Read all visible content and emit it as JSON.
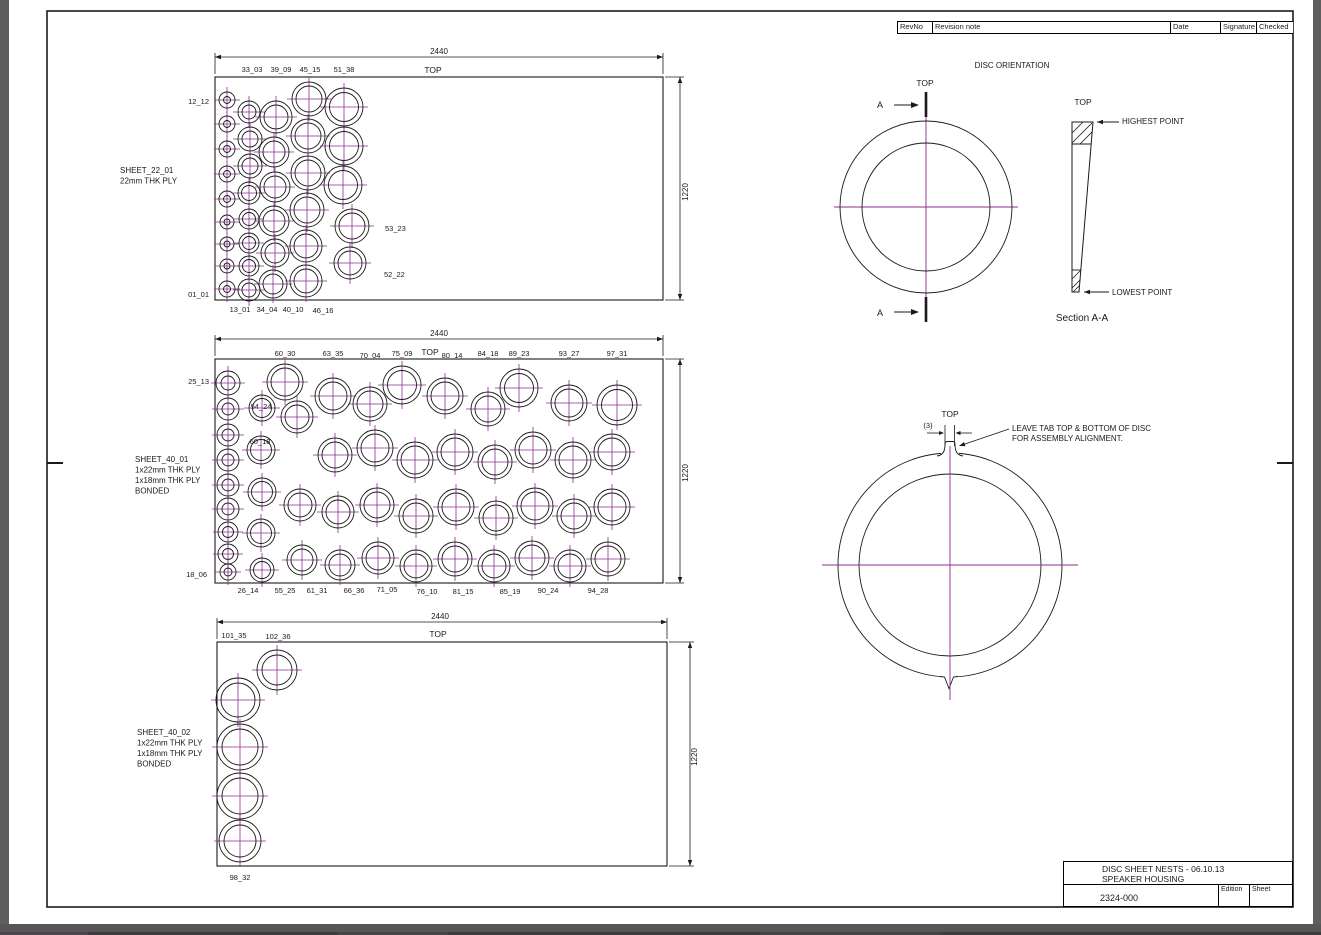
{
  "colors": {
    "paper": "#ffffff",
    "line": "#1a1a1a",
    "centerline": "#8e2d92",
    "chrome": "#5e5e5e"
  },
  "revision_table": {
    "columns": [
      "RevNo",
      "Revision note",
      "Date",
      "Signature",
      "Checked"
    ]
  },
  "title_block": {
    "line1": "DISC SHEET NESTS - 06.10.13",
    "line2": "SPEAKER HOUSING",
    "number": "2324-000",
    "edition_label": "Edition",
    "sheet_label": "Sheet"
  },
  "sheets": [
    {
      "name": "sheet-22-01",
      "note": [
        "SHEET_22_01",
        "22mm THK PLY"
      ],
      "note_pos": [
        120,
        173
      ],
      "rect": [
        215,
        77,
        448,
        223
      ],
      "dim_top": {
        "label": "2440",
        "y": 57,
        "text": [
          439,
          54
        ]
      },
      "dim_right": {
        "label": "1220",
        "x": 680,
        "text": [
          688,
          192
        ]
      },
      "top_label": {
        "t": "TOP",
        "x": 433,
        "y": 73
      },
      "labels": [
        {
          "t": "33_03",
          "x": 252,
          "y": 72
        },
        {
          "t": "39_09",
          "x": 281,
          "y": 72
        },
        {
          "t": "45_15",
          "x": 310,
          "y": 72
        },
        {
          "t": "51_38",
          "x": 344,
          "y": 72
        },
        {
          "t": "12_12",
          "x": 209,
          "y": 104,
          "a": "e"
        },
        {
          "t": "01_01",
          "x": 209,
          "y": 297,
          "a": "e"
        },
        {
          "t": "13_01",
          "x": 240,
          "y": 312
        },
        {
          "t": "34_04",
          "x": 267,
          "y": 312
        },
        {
          "t": "40_10",
          "x": 293,
          "y": 312
        },
        {
          "t": "46_16",
          "x": 323,
          "y": 313
        },
        {
          "t": "53_23",
          "x": 385,
          "y": 231,
          "a": "s"
        },
        {
          "t": "52_22",
          "x": 384,
          "y": 277,
          "a": "s"
        }
      ],
      "circles": [
        [
          227,
          100,
          8,
          3.5
        ],
        [
          227,
          124,
          8,
          3.5
        ],
        [
          227,
          149,
          8,
          3.5
        ],
        [
          227,
          174,
          8,
          3.5
        ],
        [
          227,
          199,
          8,
          3.5
        ],
        [
          227,
          222,
          7,
          3
        ],
        [
          227,
          244,
          7,
          3
        ],
        [
          227,
          266,
          7,
          3
        ],
        [
          227,
          289,
          8,
          3.5
        ],
        [
          249,
          112,
          11,
          7
        ],
        [
          250,
          139,
          12,
          8
        ],
        [
          250,
          166,
          12,
          8
        ],
        [
          249,
          193,
          11,
          7.5
        ],
        [
          249,
          219,
          10,
          6.5
        ],
        [
          249,
          243,
          10,
          6.5
        ],
        [
          249,
          266,
          10,
          6.5
        ],
        [
          249,
          290,
          11,
          7
        ],
        [
          276,
          117,
          16,
          12
        ],
        [
          274,
          152,
          15,
          11
        ],
        [
          275,
          187,
          15,
          11
        ],
        [
          274,
          221,
          15,
          11
        ],
        [
          275,
          253,
          14,
          10
        ],
        [
          273,
          284,
          14,
          10
        ],
        [
          309,
          99,
          17,
          13
        ],
        [
          308,
          136,
          17,
          13
        ],
        [
          308,
          173,
          17,
          13
        ],
        [
          307,
          210,
          17,
          13
        ],
        [
          306,
          246,
          16,
          12
        ],
        [
          306,
          281,
          16,
          12
        ],
        [
          344,
          107,
          19,
          14.5
        ],
        [
          344,
          146,
          19,
          14.5
        ],
        [
          343,
          185,
          19,
          14.5
        ],
        [
          352,
          226,
          17,
          13
        ],
        [
          350,
          263,
          16,
          12
        ]
      ]
    },
    {
      "name": "sheet-40-01",
      "note": [
        "SHEET_40_01",
        "1x22mm THK PLY",
        "1x18mm THK PLY",
        "BONDED"
      ],
      "note_pos": [
        135,
        462
      ],
      "rect": [
        215,
        359,
        448,
        224
      ],
      "dim_top": {
        "label": "2440",
        "y": 339,
        "text": [
          439,
          336
        ]
      },
      "dim_right": {
        "label": "1220",
        "x": 680,
        "text": [
          688,
          473
        ]
      },
      "top_label": {
        "t": "TOP",
        "x": 430,
        "y": 355
      },
      "labels": [
        {
          "t": "60_30",
          "x": 285,
          "y": 356
        },
        {
          "t": "63_35",
          "x": 333,
          "y": 356
        },
        {
          "t": "70_04",
          "x": 370,
          "y": 358
        },
        {
          "t": "75_09",
          "x": 402,
          "y": 356
        },
        {
          "t": "80_14",
          "x": 452,
          "y": 358
        },
        {
          "t": "84_18",
          "x": 488,
          "y": 356
        },
        {
          "t": "89_23",
          "x": 519,
          "y": 356
        },
        {
          "t": "93_27",
          "x": 569,
          "y": 356
        },
        {
          "t": "97_31",
          "x": 617,
          "y": 356
        },
        {
          "t": "25_13",
          "x": 209,
          "y": 384,
          "a": "e"
        },
        {
          "t": "18_06",
          "x": 207,
          "y": 577,
          "a": "e"
        },
        {
          "t": "54_24",
          "x": 261,
          "y": 409
        },
        {
          "t": "60_18",
          "x": 260,
          "y": 444
        },
        {
          "t": "26_14",
          "x": 248,
          "y": 593
        },
        {
          "t": "55_25",
          "x": 285,
          "y": 593
        },
        {
          "t": "61_31",
          "x": 317,
          "y": 593
        },
        {
          "t": "66_36",
          "x": 354,
          "y": 593
        },
        {
          "t": "71_05",
          "x": 387,
          "y": 592
        },
        {
          "t": "76_10",
          "x": 427,
          "y": 594
        },
        {
          "t": "81_15",
          "x": 463,
          "y": 594
        },
        {
          "t": "85_19",
          "x": 510,
          "y": 594
        },
        {
          "t": "90_24",
          "x": 548,
          "y": 593
        },
        {
          "t": "94_28",
          "x": 598,
          "y": 593
        }
      ],
      "circles": [
        [
          228,
          383,
          12,
          7
        ],
        [
          228,
          409,
          11,
          6
        ],
        [
          228,
          435,
          11,
          6
        ],
        [
          228,
          460,
          11,
          6
        ],
        [
          228,
          485,
          11,
          6
        ],
        [
          228,
          509,
          11,
          6
        ],
        [
          228,
          532,
          10,
          5.5
        ],
        [
          228,
          554,
          10,
          5.5
        ],
        [
          228,
          572,
          8,
          4
        ],
        [
          262,
          408,
          13,
          9.5
        ],
        [
          261,
          450,
          14,
          10.5
        ],
        [
          262,
          492,
          14,
          10.5
        ],
        [
          261,
          533,
          14,
          10.5
        ],
        [
          262,
          570,
          12,
          8.5
        ],
        [
          297,
          417,
          16,
          12
        ],
        [
          285,
          382,
          18,
          14
        ],
        [
          333,
          396,
          18,
          14
        ],
        [
          370,
          404,
          17,
          13
        ],
        [
          402,
          385,
          19,
          14.5
        ],
        [
          445,
          396,
          18,
          14
        ],
        [
          488,
          409,
          17,
          13
        ],
        [
          519,
          388,
          19,
          14.5
        ],
        [
          569,
          403,
          18,
          14
        ],
        [
          617,
          405,
          20,
          15.5
        ],
        [
          335,
          455,
          17,
          13
        ],
        [
          375,
          448,
          18,
          14
        ],
        [
          415,
          460,
          18,
          14
        ],
        [
          455,
          452,
          18,
          14
        ],
        [
          495,
          462,
          17,
          13
        ],
        [
          533,
          450,
          18,
          14
        ],
        [
          573,
          460,
          18,
          14
        ],
        [
          612,
          452,
          18,
          14
        ],
        [
          300,
          505,
          16,
          12
        ],
        [
          338,
          512,
          16,
          12
        ],
        [
          377,
          505,
          17,
          13
        ],
        [
          416,
          516,
          17,
          13
        ],
        [
          456,
          507,
          18,
          14
        ],
        [
          496,
          518,
          17,
          13
        ],
        [
          535,
          506,
          18,
          14
        ],
        [
          574,
          516,
          17,
          13
        ],
        [
          612,
          507,
          18,
          14
        ],
        [
          302,
          560,
          15,
          11
        ],
        [
          340,
          565,
          15,
          11
        ],
        [
          378,
          558,
          16,
          12
        ],
        [
          416,
          566,
          16,
          12
        ],
        [
          455,
          559,
          17,
          13
        ],
        [
          494,
          566,
          16,
          12
        ],
        [
          532,
          558,
          17,
          13
        ],
        [
          570,
          566,
          16,
          12
        ],
        [
          608,
          559,
          17,
          13
        ]
      ]
    },
    {
      "name": "sheet-40-02",
      "note": [
        "SHEET_40_02",
        "1x22mm THK PLY",
        "1x18mm THK PLY",
        "BONDED"
      ],
      "note_pos": [
        137,
        735
      ],
      "rect": [
        217,
        642,
        450,
        224
      ],
      "dim_top": {
        "label": "2440",
        "y": 622,
        "text": [
          440,
          619
        ]
      },
      "dim_right": {
        "label": "1220",
        "x": 690,
        "text": [
          697,
          757
        ]
      },
      "top_label": {
        "t": "TOP",
        "x": 438,
        "y": 637
      },
      "labels": [
        {
          "t": "101_35",
          "x": 234,
          "y": 638
        },
        {
          "t": "102_36",
          "x": 278,
          "y": 639
        },
        {
          "t": "98_32",
          "x": 240,
          "y": 880
        }
      ],
      "circles": [
        [
          277,
          670,
          20,
          15
        ],
        [
          238,
          700,
          22,
          17
        ],
        [
          240,
          747,
          23,
          18
        ],
        [
          240,
          796,
          23,
          18
        ],
        [
          240,
          841,
          21,
          16
        ]
      ]
    }
  ],
  "orientation": {
    "title": "DISC ORIENTATION",
    "top_label": "TOP",
    "section_letter": "A",
    "highest_point": "HIGHEST POINT",
    "lowest_point": "LOWEST POINT",
    "section_title": "Section A-A"
  },
  "tab_detail": {
    "top_label": "TOP",
    "dim": "(3)",
    "note_line1": "LEAVE TAB TOP & BOTTOM OF DISC",
    "note_line2": "FOR ASSEMBLY ALIGNMENT."
  }
}
